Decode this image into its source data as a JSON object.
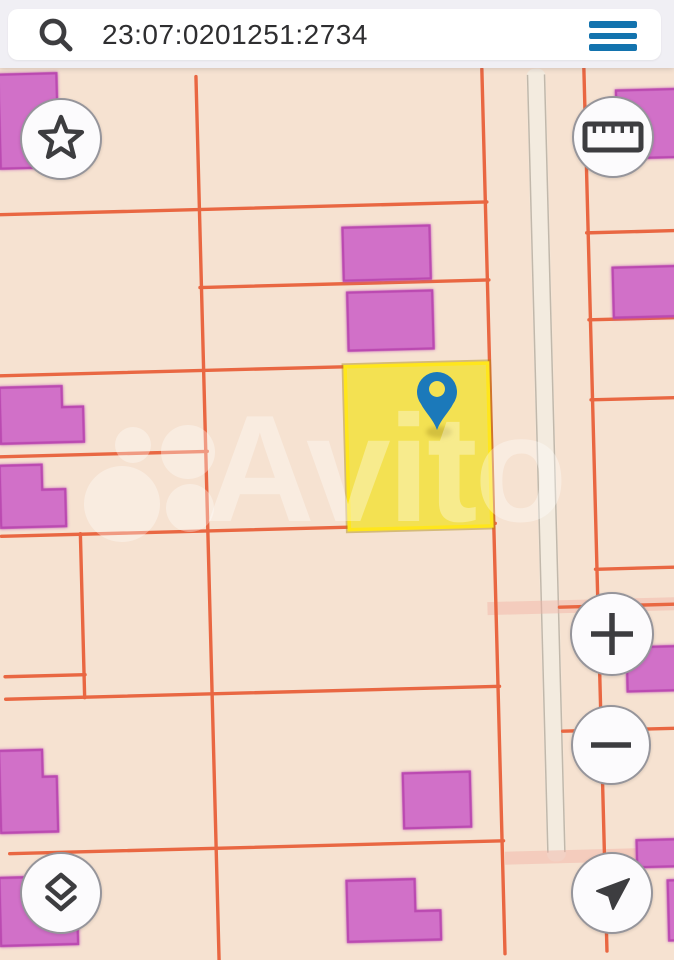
{
  "app": {
    "name": "cadastral map viewer"
  },
  "search": {
    "value": "23:07:0201251:2734",
    "icon": "search-icon",
    "menu_icon": "hamburger-icon"
  },
  "map": {
    "watermark": "Avito",
    "selected_parcel": {
      "cadastral_number": "23:07:0201251:2734",
      "marker": "map-pin-icon"
    },
    "controls": [
      {
        "id": "favorite",
        "icon": "star-icon"
      },
      {
        "id": "measure",
        "icon": "ruler-icon"
      },
      {
        "id": "zoom-in",
        "icon": "plus-icon"
      },
      {
        "id": "zoom-out",
        "icon": "minus-icon"
      },
      {
        "id": "layers",
        "icon": "layers-icon"
      },
      {
        "id": "locate",
        "icon": "navigation-arrow-icon"
      }
    ]
  },
  "colors": {
    "topbar_bg": "#f0eff4",
    "field_bg": "#ffffff",
    "text_dark": "#2e2e30",
    "accent_blue": "#1373ae",
    "icon_dark": "#3d3d40",
    "map_bg": "#f6e2d1",
    "parcel_line": "#e96742",
    "road_fill": "#f3ebdf",
    "road_edge": "#b9b0a3",
    "building_fill": "#d170c8",
    "building_stroke": "#bb4ab1",
    "highlight_fill": "#f3e152",
    "highlight_stroke": "#ffe61c",
    "highlight_glow": "rgba(170,138,10,0.45)",
    "pin_blue": "#1b79ba",
    "watermark_white": "rgba(255,255,255,0.34)",
    "btn_bg": "#fcfbfd",
    "btn_border": "#96959b",
    "pink_band": "rgba(242,178,164,0.45)"
  }
}
